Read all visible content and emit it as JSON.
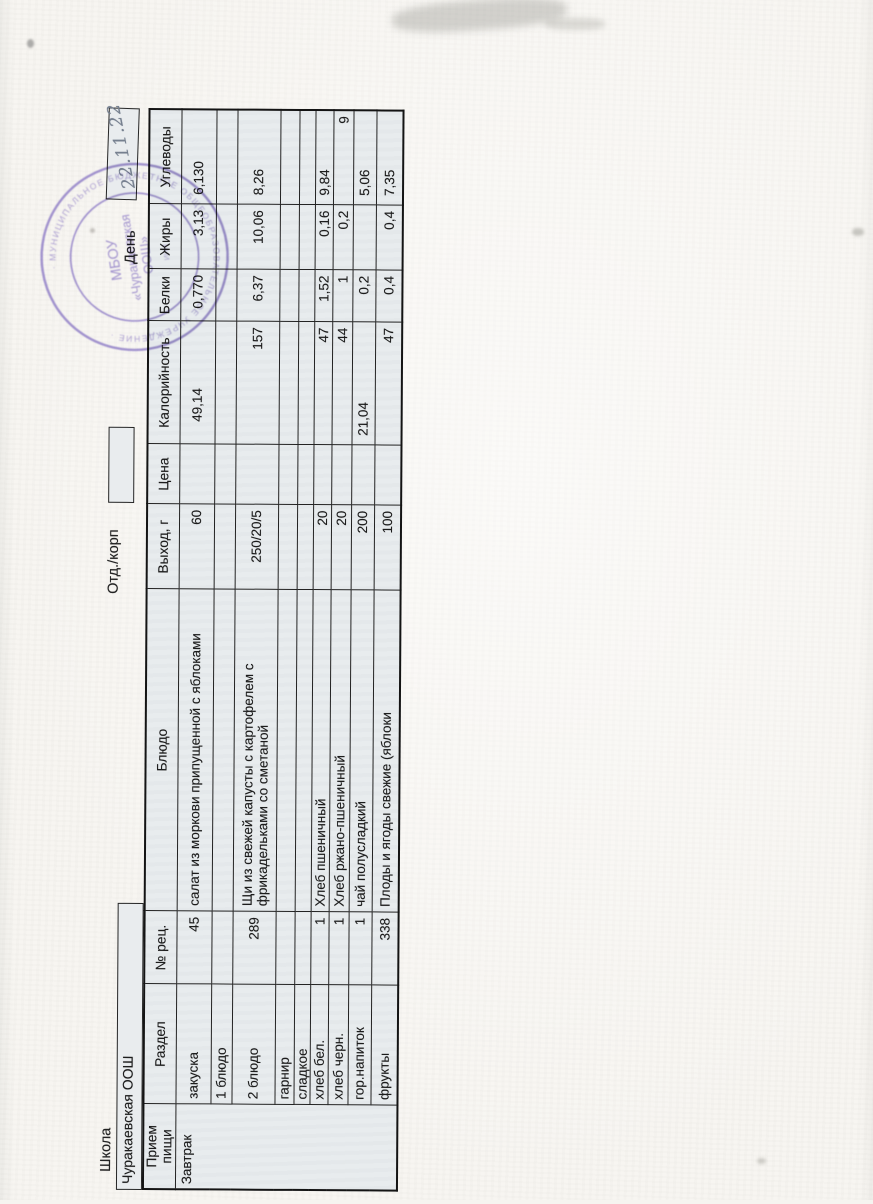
{
  "page": {
    "school_label": "Школа",
    "school_name": "Чуракаевская ООШ",
    "dept_label": "Отд./корп",
    "dept_value": "",
    "day_label": "День",
    "day_value_handwritten": "22.11.22"
  },
  "stamp": {
    "center_line1": "МБОУ",
    "center_line2": "«Чуракаевская",
    "center_line3": "ООШ»",
    "center_line4": "ИНН",
    "ring_text": "· МУНИЦИПАЛЬНОЕ БЮДЖЕТНОЕ ОБЩЕОБРАЗОВАТЕЛЬНОЕ УЧРЕЖДЕНИЕ ·",
    "color": "#8572c2"
  },
  "table": {
    "headers": {
      "meal": "Прием пищи",
      "razdel": "Раздел",
      "rec": "№ рец.",
      "dish": "Блюдо",
      "out": "Выход, г",
      "price": "Цена",
      "kcal": "Калорийность",
      "protein": "Белки",
      "fat": "Жиры",
      "carbs": "Углеводы"
    },
    "meal_value": "Завтрак",
    "rows": [
      {
        "razdel": "закуска",
        "rec": "45",
        "dish": "салат из моркови припущенной с яблоками",
        "out": "60",
        "price": "",
        "kcal": "49,14",
        "protein": "0,770",
        "fat": "3,13",
        "carbs": "6,130"
      },
      {
        "razdel": "1 блюдо",
        "rec": "",
        "dish": "",
        "out": "",
        "price": "",
        "kcal": "",
        "protein": "",
        "fat": "",
        "carbs": ""
      },
      {
        "razdel": "2 блюдо",
        "rec": "289",
        "dish": "Щи из свежей капусты с картофелем с фрикадельками со сметаной",
        "out": "250/20/5",
        "price": "",
        "kcal": "157",
        "protein": "6,37",
        "fat": "10,06",
        "carbs": "8,26"
      },
      {
        "razdel": "гарнир",
        "rec": "",
        "dish": "",
        "out": "",
        "price": "",
        "kcal": "",
        "protein": "",
        "fat": "",
        "carbs": ""
      },
      {
        "razdel": "сладкое",
        "rec": "",
        "dish": "",
        "out": "",
        "price": "",
        "kcal": "",
        "protein": "",
        "fat": "",
        "carbs": ""
      },
      {
        "razdel": "хлеб бел.",
        "rec": "1",
        "dish": "Хлеб пшеничный",
        "out": "20",
        "price": "",
        "kcal": "47",
        "protein": "1,52",
        "fat": "0,16",
        "carbs": "9,84"
      },
      {
        "razdel": "хлеб черн.",
        "rec": "1",
        "dish": "Хлеб ржано-пшеничный",
        "out": "20",
        "price": "",
        "kcal": "44",
        "protein": "1",
        "fat": "0,2",
        "carbs": "9"
      },
      {
        "razdel": "гор.напиток",
        "rec": "1",
        "dish": "чай полусладкий",
        "out": "200",
        "price": "",
        "kcal": "21,04",
        "protein": "0,2",
        "fat": "",
        "carbs": "5,06"
      },
      {
        "razdel": "фрукты",
        "rec": "338",
        "dish": "Плоды и ягоды свежие (яблоки",
        "out": "100",
        "price": "",
        "kcal": "47",
        "protein": "0,4",
        "fat": "0,4",
        "carbs": "7,35"
      }
    ]
  },
  "colors": {
    "paper": "#f6f4f0",
    "cell_fill": "#e8ecee",
    "ink": "#1c1c1c",
    "stamp_purple": "#8572c2",
    "handwriting_ink": "#76808f"
  }
}
